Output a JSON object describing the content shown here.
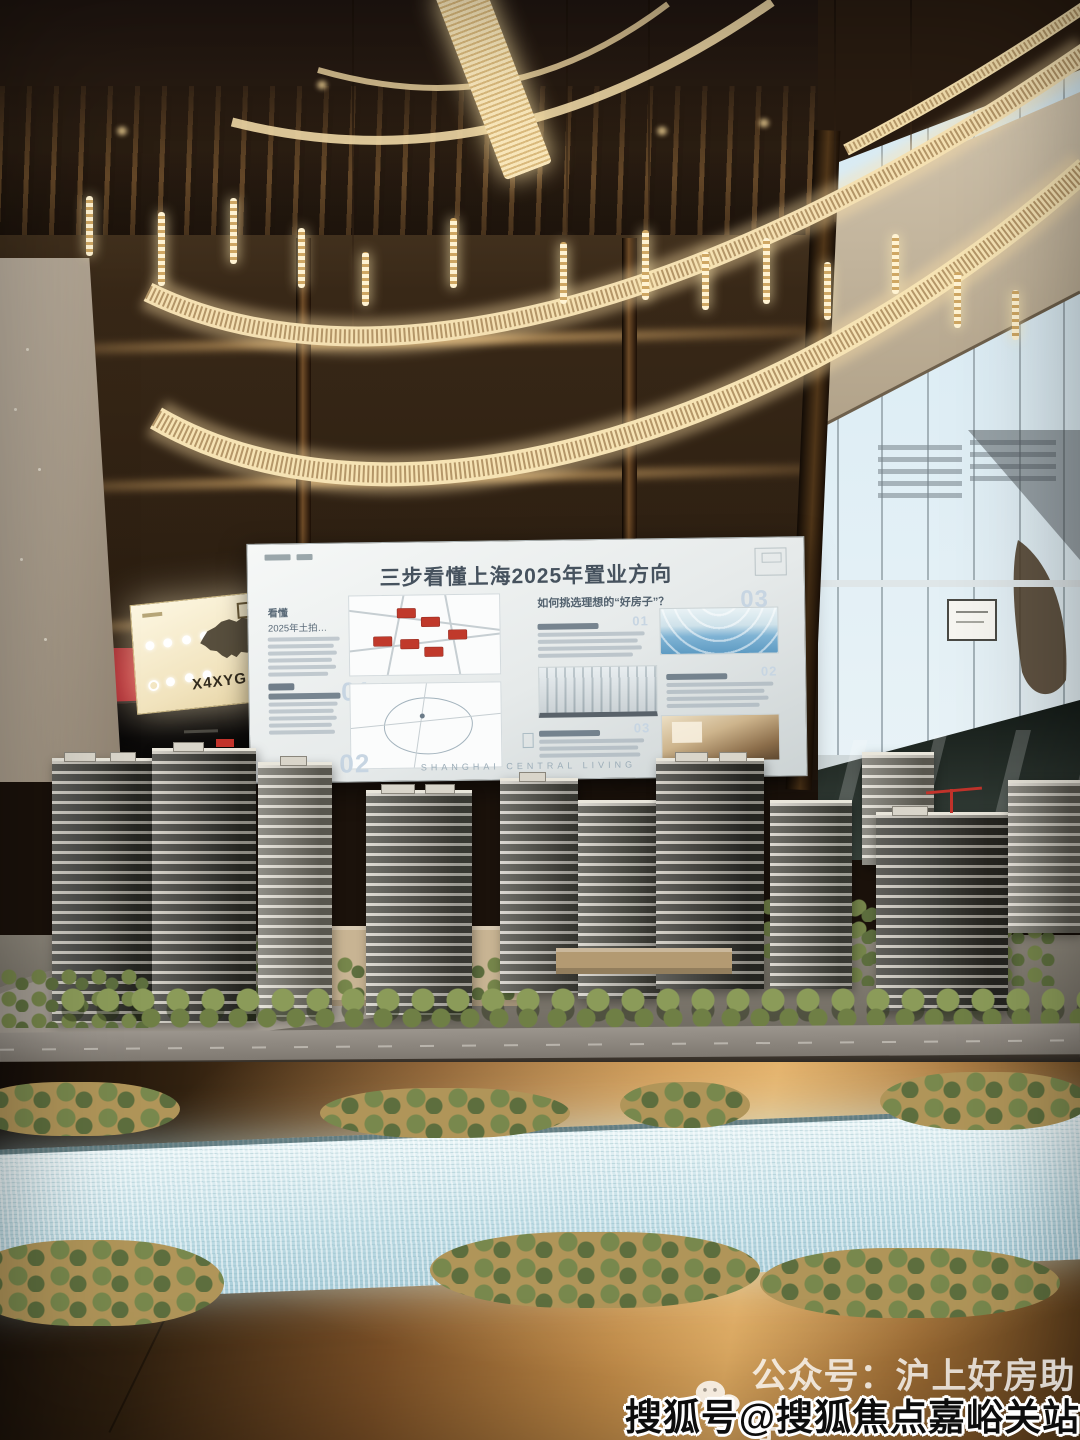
{
  "photo": {
    "description": "Real-estate sales gallery: architectural scale model of a residential development under a ring LED chandelier, with presentation boards"
  },
  "main_board": {
    "headline": "三步看懂上海2025年置业方向",
    "left_section_a": {
      "kicker": "看懂",
      "title": "2025年土拍…"
    },
    "numbers": {
      "left_a": "01",
      "left_b": "02",
      "right": "03"
    },
    "right_heading": "如何挑选理想的“好房子”？",
    "right_item_numbers": [
      "01",
      "02",
      "03"
    ],
    "footer": "SHANGHAI CENTRAL LIVING"
  },
  "lightbox": {
    "code": "X4XYG"
  },
  "watermarks": {
    "wechat": "公众号：沪上好房助手",
    "sohu": "搜狐号@搜狐焦点嘉峪关站"
  },
  "colors": {
    "chandelier": "#f6e3b4",
    "river": "#cfe8ee",
    "table_copper": "#c08a47",
    "board_bg": "#eef2f2",
    "red_tag": "#c0392b"
  }
}
